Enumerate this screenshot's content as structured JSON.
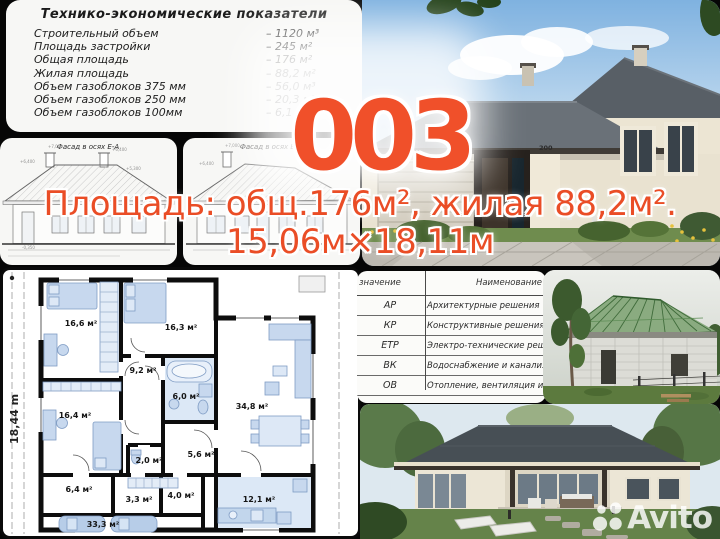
{
  "project": {
    "number": "003",
    "area_line1": "Площадь: общ.176м², жилая 88,2м².",
    "area_line2": "15,06м×18,11м"
  },
  "tech_panel": {
    "title": "Технико-экономические показатели",
    "rows": [
      {
        "label": "Строительный объем",
        "value": "– 1120 м³"
      },
      {
        "label": "Площадь застройки",
        "value": "– 245 м²"
      },
      {
        "label": "Общая площадь",
        "value": "– 176 м²"
      },
      {
        "label": "Жилая площадь",
        "value": "– 88,2 м²"
      },
      {
        "label": "Объем газоблоков 375 мм",
        "value": "– 56,0 м³"
      },
      {
        "label": "Объем газоблоков 250 мм",
        "value": "– 20,3 м³"
      },
      {
        "label": "Объем газоблоков 100мм",
        "value": "– 6,1 м³"
      }
    ]
  },
  "facades": {
    "left_label": "Фасад в осях Е-А",
    "right_label": "Фасад в осях Б-1",
    "marks": [
      "+7,000",
      "+6,400",
      "+5,300",
      "+5,400",
      "+2,300",
      "+0,750",
      "-0,350"
    ]
  },
  "floor_plan": {
    "side_dimension": "18,44 m",
    "rooms": [
      {
        "area": "16,6 м²"
      },
      {
        "area": "16,3 м²"
      },
      {
        "area": "9,2 м²"
      },
      {
        "area": "6,0 м²"
      },
      {
        "area": "34,8 м²"
      },
      {
        "area": "16,4 м²"
      },
      {
        "area": "2,0 м²"
      },
      {
        "area": "5,6 м²"
      },
      {
        "area": "6,4 м²"
      },
      {
        "area": "3,3 м²"
      },
      {
        "area": "4,0 м²"
      },
      {
        "area": "12,1 м²"
      },
      {
        "area": "33,3 м²"
      }
    ]
  },
  "legend_table": {
    "col1_header": "значение",
    "col2_header": "Наименование",
    "rows": [
      {
        "code": "АР",
        "name": "Архитектурные решения"
      },
      {
        "code": "КР",
        "name": "Конструктивные решения"
      },
      {
        "code": "ЕТР",
        "name": "Электро-технические реше"
      },
      {
        "code": "ВК",
        "name": "Водоснабжение и канализа"
      },
      {
        "code": "ОВ",
        "name": "Отопление, вентиляция и к"
      }
    ]
  },
  "photos": {
    "house_number": "200"
  },
  "watermark": {
    "text": "Avito"
  },
  "colors": {
    "accent": "#ee4f28"
  }
}
